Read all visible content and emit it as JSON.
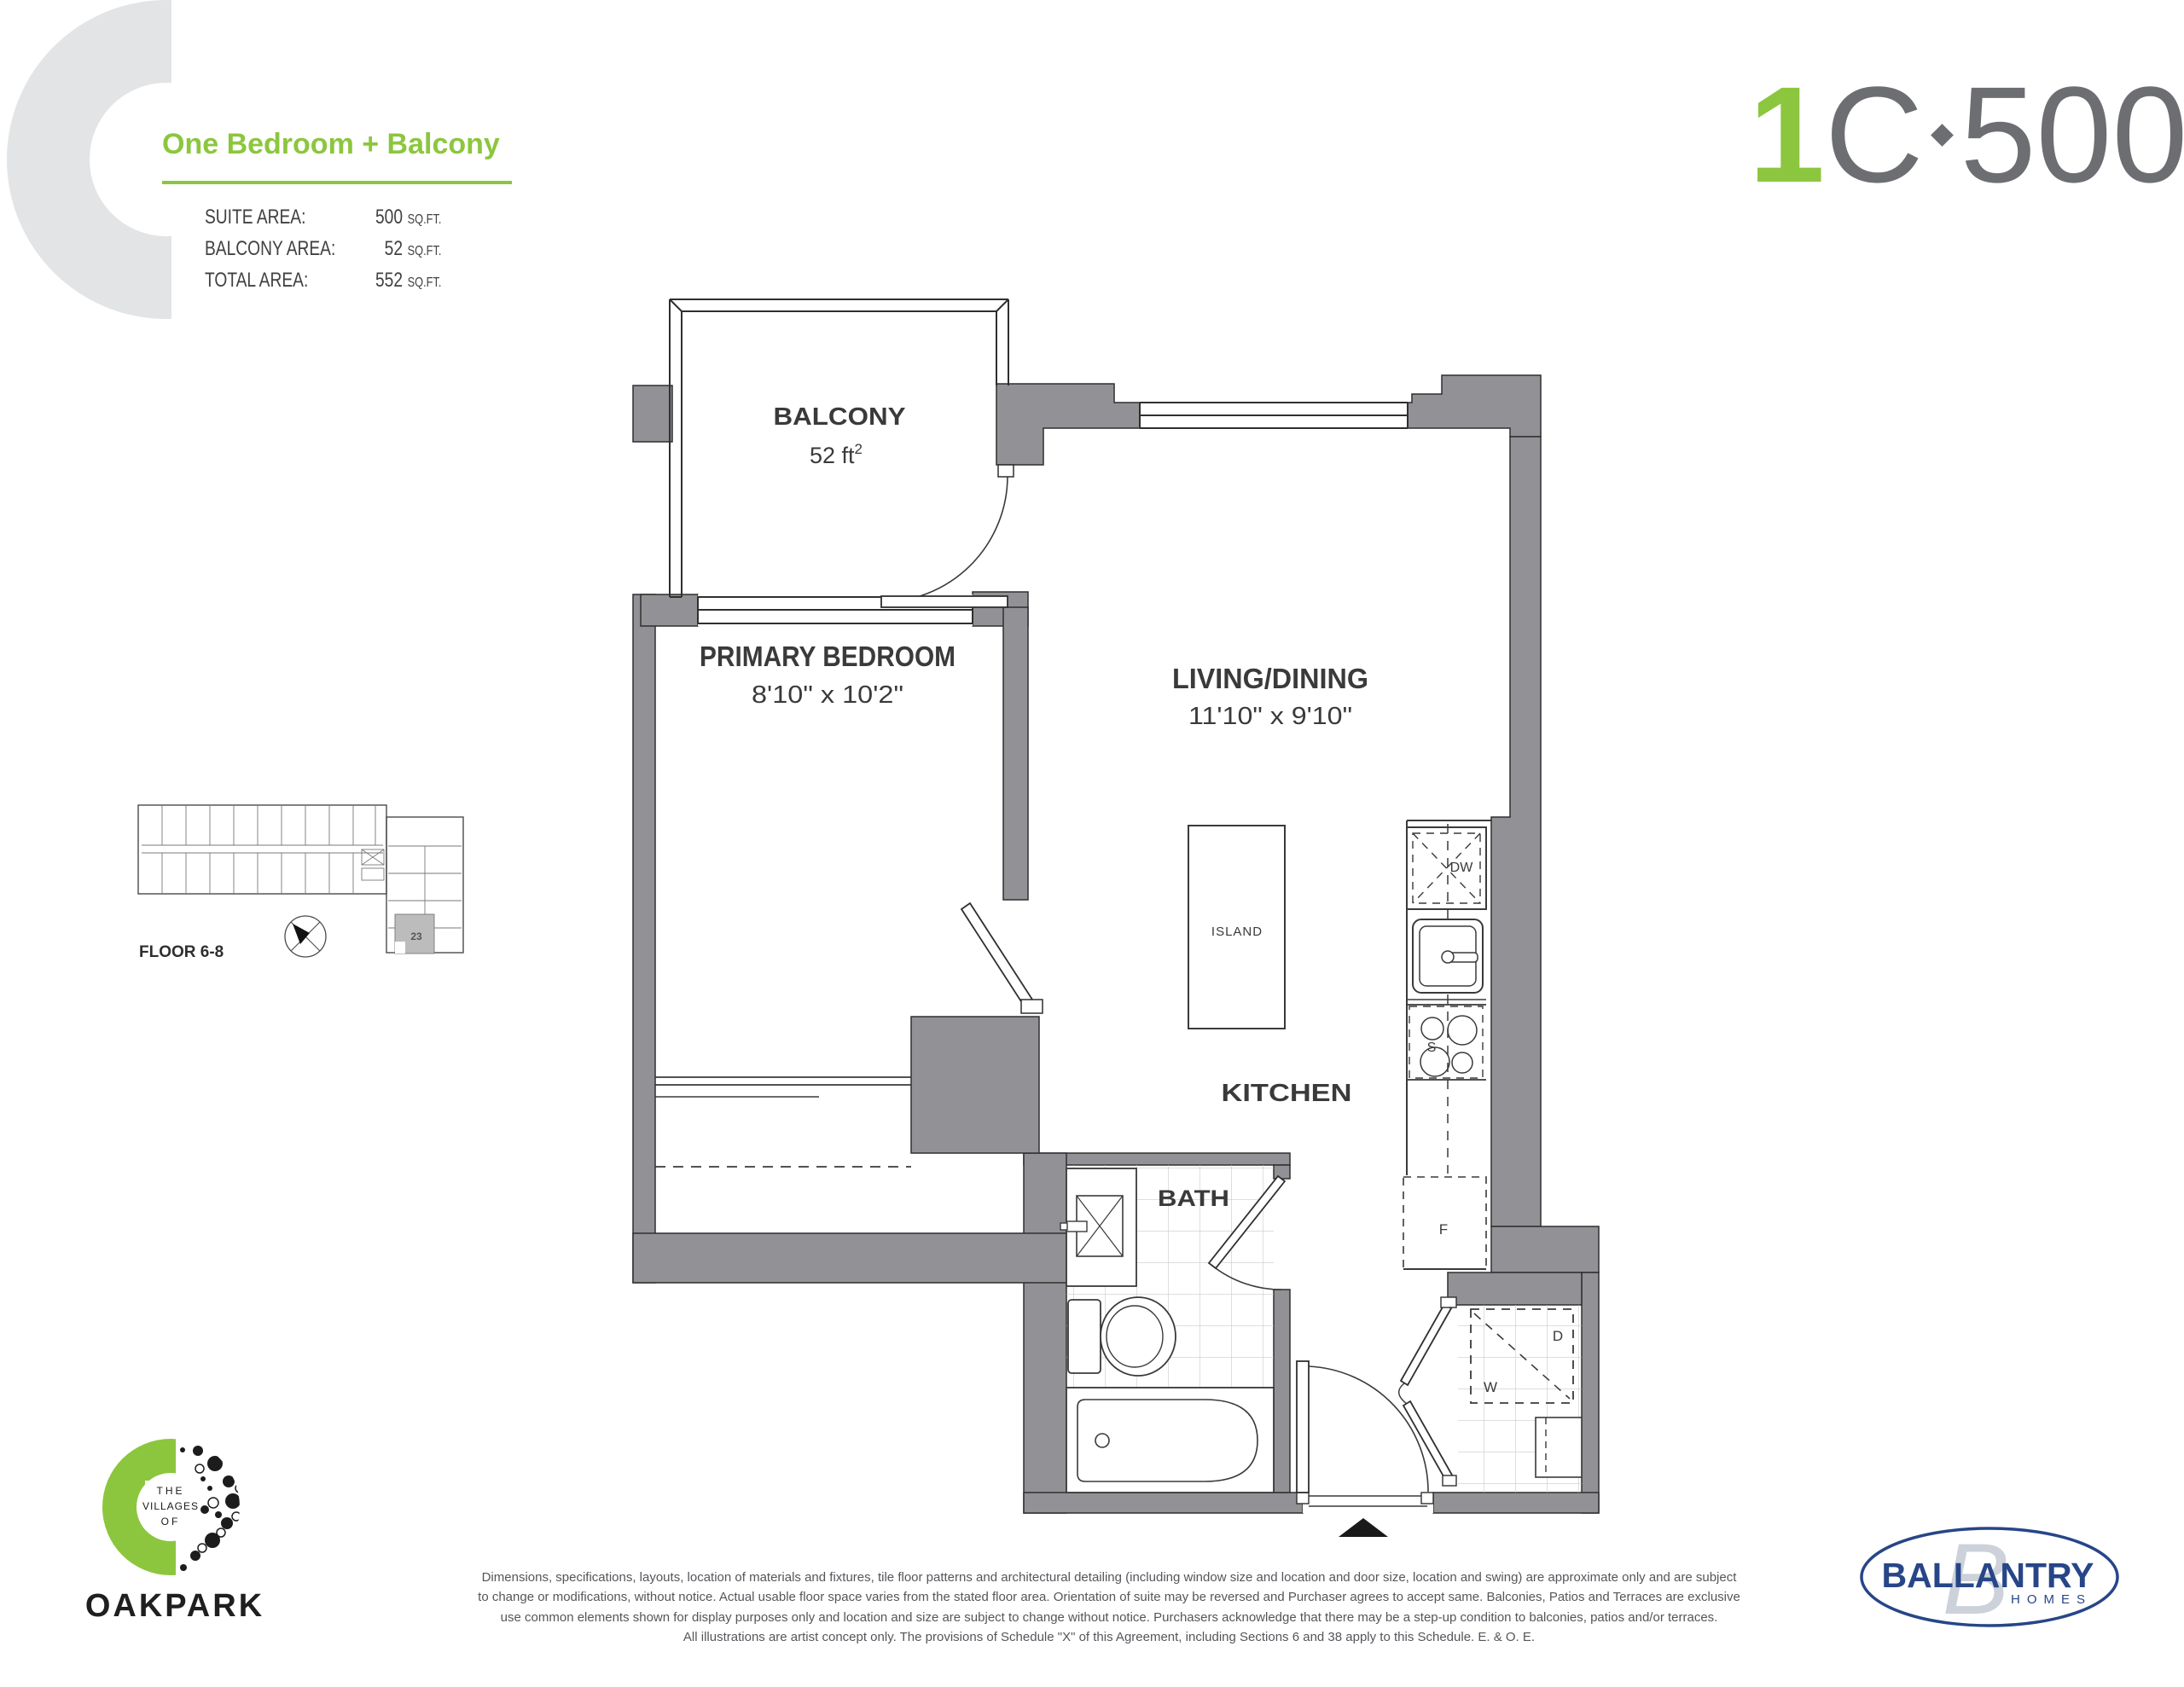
{
  "header": {
    "letter": "C",
    "title": "One Bedroom + Balcony",
    "accent_color": "#8CC63E",
    "areas": [
      {
        "label": "SUITE AREA:",
        "value": "500",
        "unit": "SQ.FT."
      },
      {
        "label": "BALCONY AREA:",
        "value": "52",
        "unit": "SQ.FT."
      },
      {
        "label": "TOTAL AREA:",
        "value": "552",
        "unit": "SQ.FT."
      }
    ],
    "plan_code": {
      "digit": "1",
      "letter": "C",
      "sqft": "500",
      "unit_top": "SQ.",
      "unit_bottom": "FT."
    }
  },
  "floorplan": {
    "wall_color": "#929296",
    "balcony": {
      "name": "BALCONY",
      "area": "52 ft",
      "area_sup": "2"
    },
    "bedroom": {
      "name": "PRIMARY BEDROOM",
      "dims": "8'10\" x 10'2\""
    },
    "living": {
      "name": "LIVING/DINING",
      "dims": "11'10\" x 9'10\""
    },
    "kitchen": {
      "name": "KITCHEN"
    },
    "bath": {
      "name": "BATH"
    },
    "island": {
      "name": "ISLAND"
    },
    "appliances": {
      "dishwasher": "DW",
      "stove": "S",
      "fridge": "F",
      "washer": "W",
      "dryer": "D"
    }
  },
  "keyplan": {
    "floor_label": "FLOOR 6-8",
    "unit_number": "23"
  },
  "footer": {
    "oakpark": {
      "pre1": "THE",
      "pre2": "VILLAGES",
      "pre3": "OF",
      "name": "OAKPARK"
    },
    "disclaimer": {
      "line1": "Dimensions, specifications, layouts, location of materials and fixtures, tile floor patterns and architectural detailing (including window size and location and door size, location and swing) are approximate only and are subject",
      "line2": "to change or modifications, without notice. Actual usable floor space varies from the stated floor area. Orientation of suite may be reversed and Purchaser agrees to accept same. Balconies, Patios and Terraces are exclusive",
      "line3": "use common elements shown for display purposes only and location and size are subject to change without notice. Purchasers acknowledge that there may be a step-up condition to balconies, patios and/or terraces.",
      "line4": "All illustrations are artist concept only. The provisions of Schedule \"X\" of this Agreement, including Sections 6 and 38 apply to this Schedule. E. & O. E."
    },
    "ballantry": {
      "name": "BALLANTRY",
      "sub": "HOMES",
      "navy": "#274688"
    }
  }
}
